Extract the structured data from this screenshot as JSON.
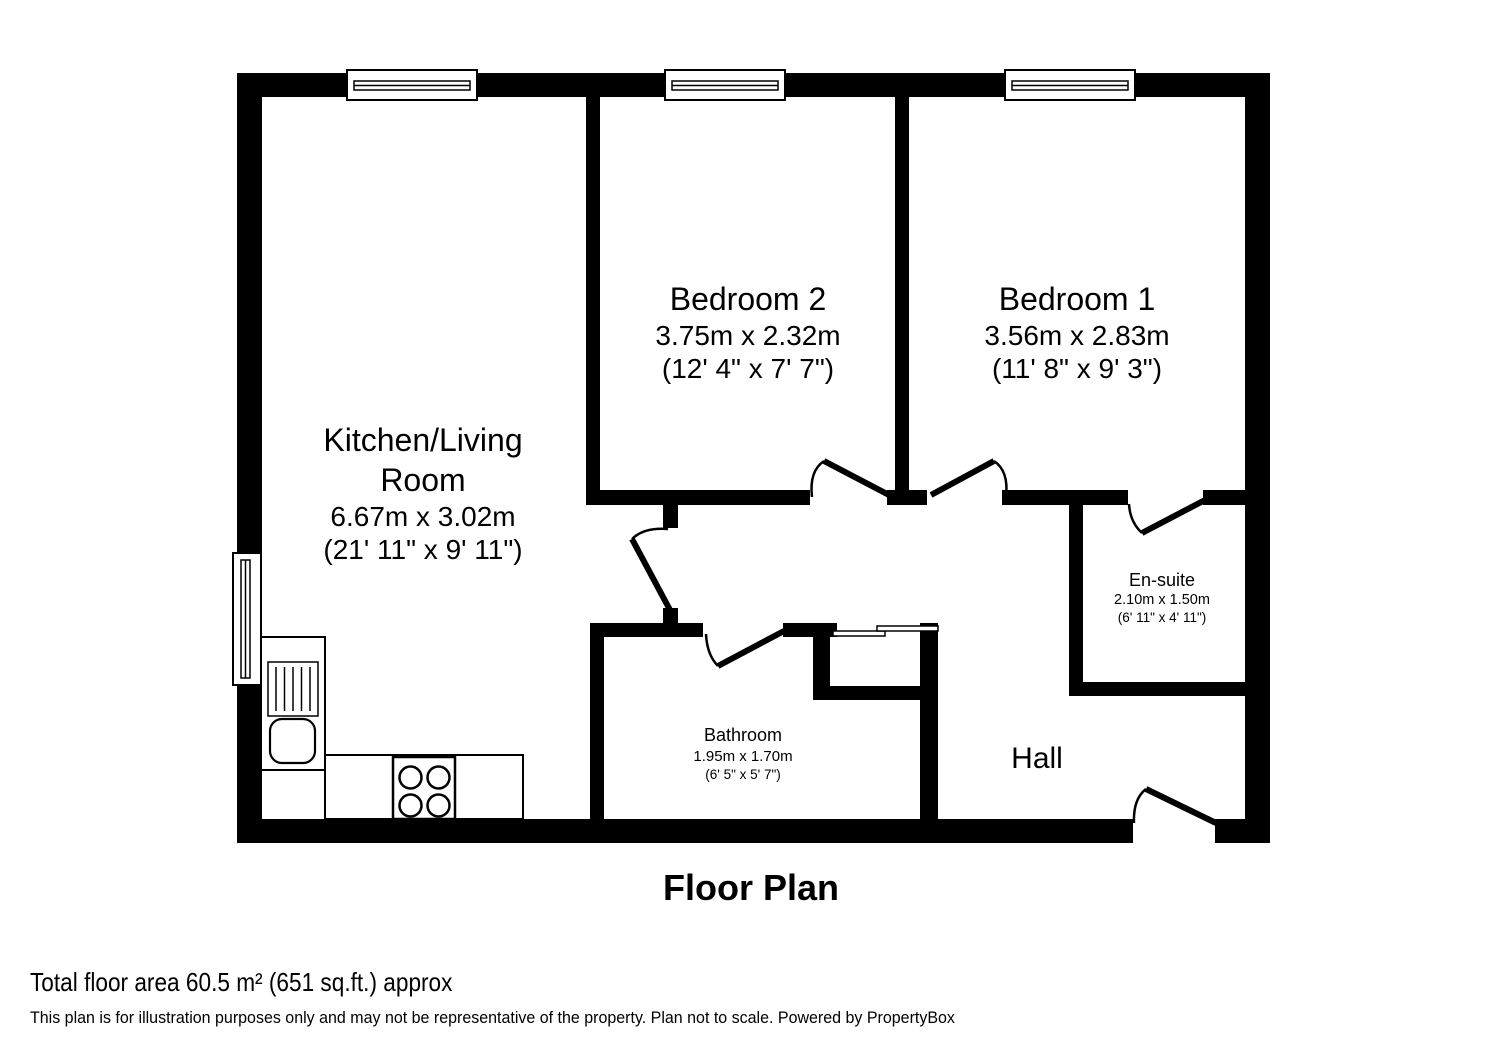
{
  "title": "Floor Plan",
  "rooms": {
    "kitchen_living": {
      "name_line1": "Kitchen/Living",
      "name_line2": "Room",
      "metric": "6.67m x 3.02m",
      "imperial": "(21' 11\" x 9' 11\")"
    },
    "bedroom2": {
      "name": "Bedroom 2",
      "metric": "3.75m x 2.32m",
      "imperial": "(12' 4\" x 7' 7\")"
    },
    "bedroom1": {
      "name": "Bedroom 1",
      "metric": "3.56m x 2.83m",
      "imperial": "(11' 8\" x 9' 3\")"
    },
    "ensuite": {
      "name": "En-suite",
      "metric": "2.10m x 1.50m",
      "imperial": "(6' 11\" x 4' 11\")"
    },
    "bathroom": {
      "name": "Bathroom",
      "metric": "1.95m x 1.70m",
      "imperial": "(6' 5\" x 5' 7\")"
    },
    "hall": {
      "name": "Hall"
    }
  },
  "footer": {
    "area": "Total floor area 60.5 m² (651 sq.ft.) approx",
    "disclaimer": "This plan is for illustration purposes only and may not be representative of the property. Plan not to scale. Powered by PropertyBox"
  },
  "colors": {
    "wall": "#000000",
    "background": "#ffffff",
    "text": "#000000"
  }
}
